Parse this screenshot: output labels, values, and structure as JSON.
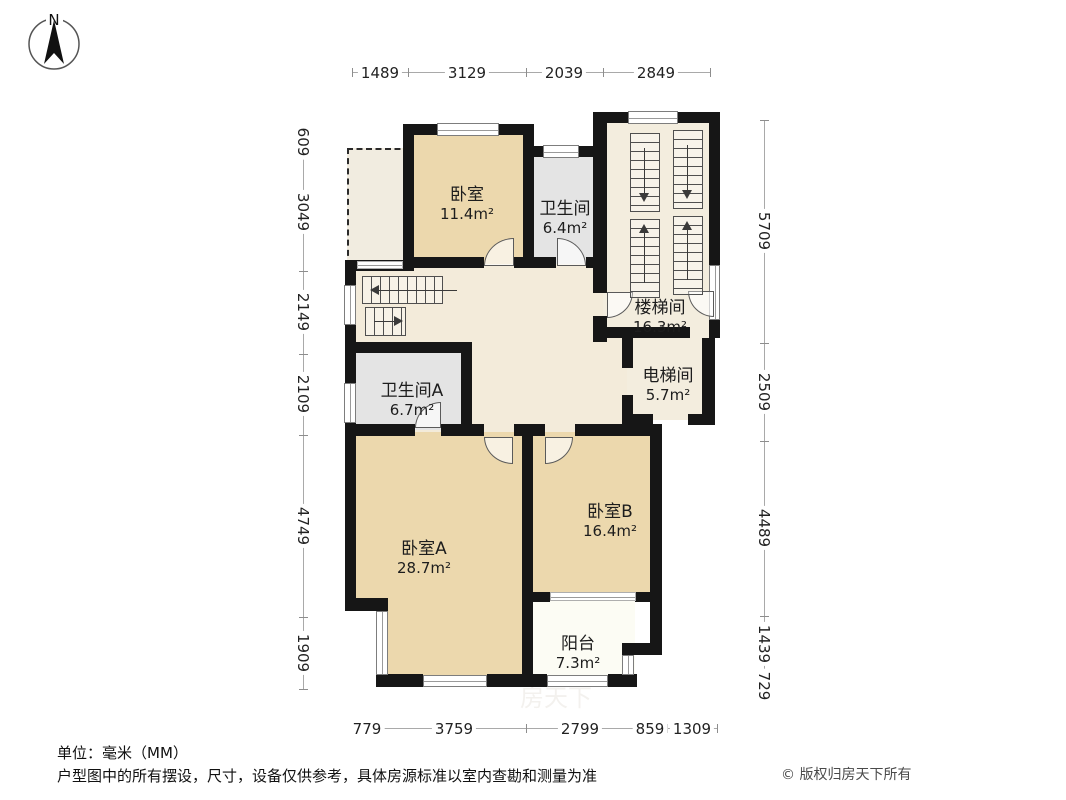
{
  "compass": {
    "label": "N"
  },
  "rooms": [
    {
      "name": "卧室",
      "area": "11.4m²"
    },
    {
      "name": "卫生间",
      "area": "6.4m²"
    },
    {
      "name": "楼梯间",
      "area": "16.3m²"
    },
    {
      "name": "电梯间",
      "area": "5.7m²"
    },
    {
      "name": "卫生间A",
      "area": "6.7m²"
    },
    {
      "name": "卧室A",
      "area": "28.7m²"
    },
    {
      "name": "卧室B",
      "area": "16.4m²"
    },
    {
      "name": "阳台",
      "area": "7.3m²"
    }
  ],
  "dimensions": {
    "top": [
      "1489",
      "3129",
      "2039",
      "2849"
    ],
    "left": [
      "609",
      "3049",
      "2149",
      "2109",
      "4749",
      "1909"
    ],
    "right": [
      "5709",
      "2509",
      "4489",
      "1439",
      "729"
    ],
    "bottom": [
      "779",
      "3759",
      "2799",
      "859",
      "1309"
    ]
  },
  "footer": {
    "unit": "单位：毫米（MM）",
    "disclaimer": "户型图中的所有摆设，尺寸，设备仅供参考，具体房源标准以室内查勘和测量为准",
    "copyright": "© 版权归房天下所有"
  },
  "watermark": "房天下",
  "colors": {
    "wall": "#161616",
    "room_tan": "#ecd8ad",
    "room_gray": "#e4e4e4",
    "hall_cream": "#f3ebda",
    "stair_cream": "#f3edde",
    "balcony_white": "#fcfcf4"
  }
}
